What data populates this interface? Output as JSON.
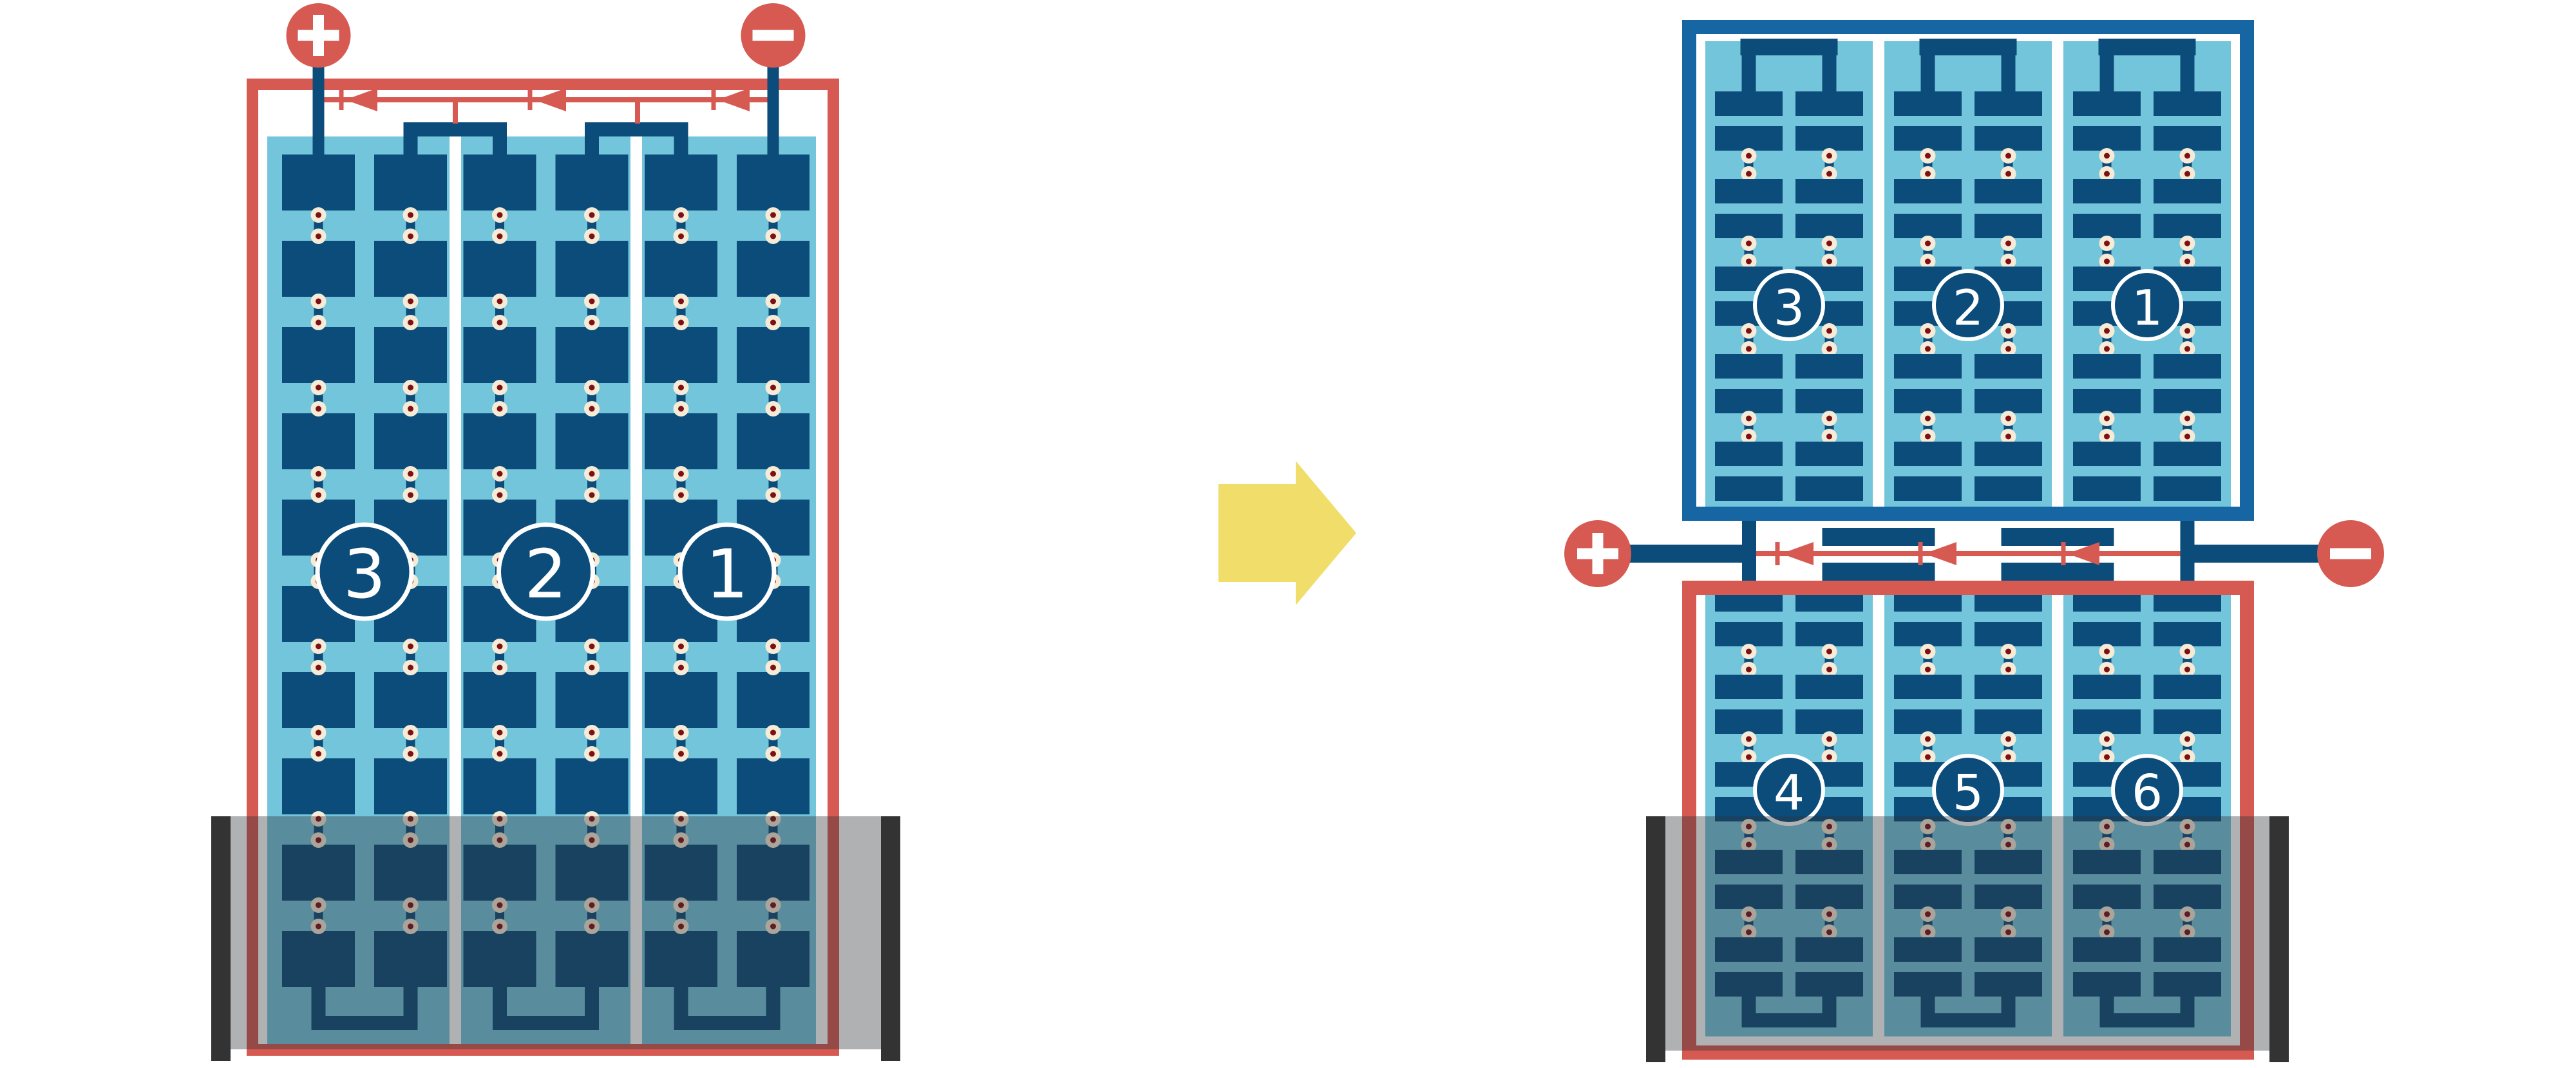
{
  "title": "Battery cell series connection diagram (single 3-cell stack rearranged into two stacked 3-cell banks)",
  "colors": {
    "navy": "#0C4C7A",
    "frameBlue": "#1766A4",
    "lightBlue": "#73C5DB",
    "red": "#D65A52",
    "cream": "#F6EBD7",
    "dotCore": "#7E1012",
    "yellow": "#F1DD6A",
    "overlay": "rgba(47,50,55,0.38)",
    "caseBar": "#333333",
    "white": "#FFFFFF"
  },
  "before": {
    "name": "single-stack-battery",
    "terminals": {
      "positive": "+",
      "negative": "−"
    },
    "cells": [
      {
        "label": "3"
      },
      {
        "label": "2"
      },
      {
        "label": "1"
      }
    ],
    "flow_arrow_count": 3,
    "flow_direction": "toward-positive"
  },
  "transform_arrow": {
    "direction": "right"
  },
  "after": {
    "name": "split-double-stack-battery",
    "terminals": {
      "positive": "+",
      "negative": "−"
    },
    "top_unit": {
      "cells": [
        {
          "label": "3"
        },
        {
          "label": "2"
        },
        {
          "label": "1"
        }
      ]
    },
    "bottom_unit": {
      "cells": [
        {
          "label": "4"
        },
        {
          "label": "5"
        },
        {
          "label": "6"
        }
      ]
    },
    "flow_arrow_count": 3,
    "flow_direction": "toward-positive"
  }
}
